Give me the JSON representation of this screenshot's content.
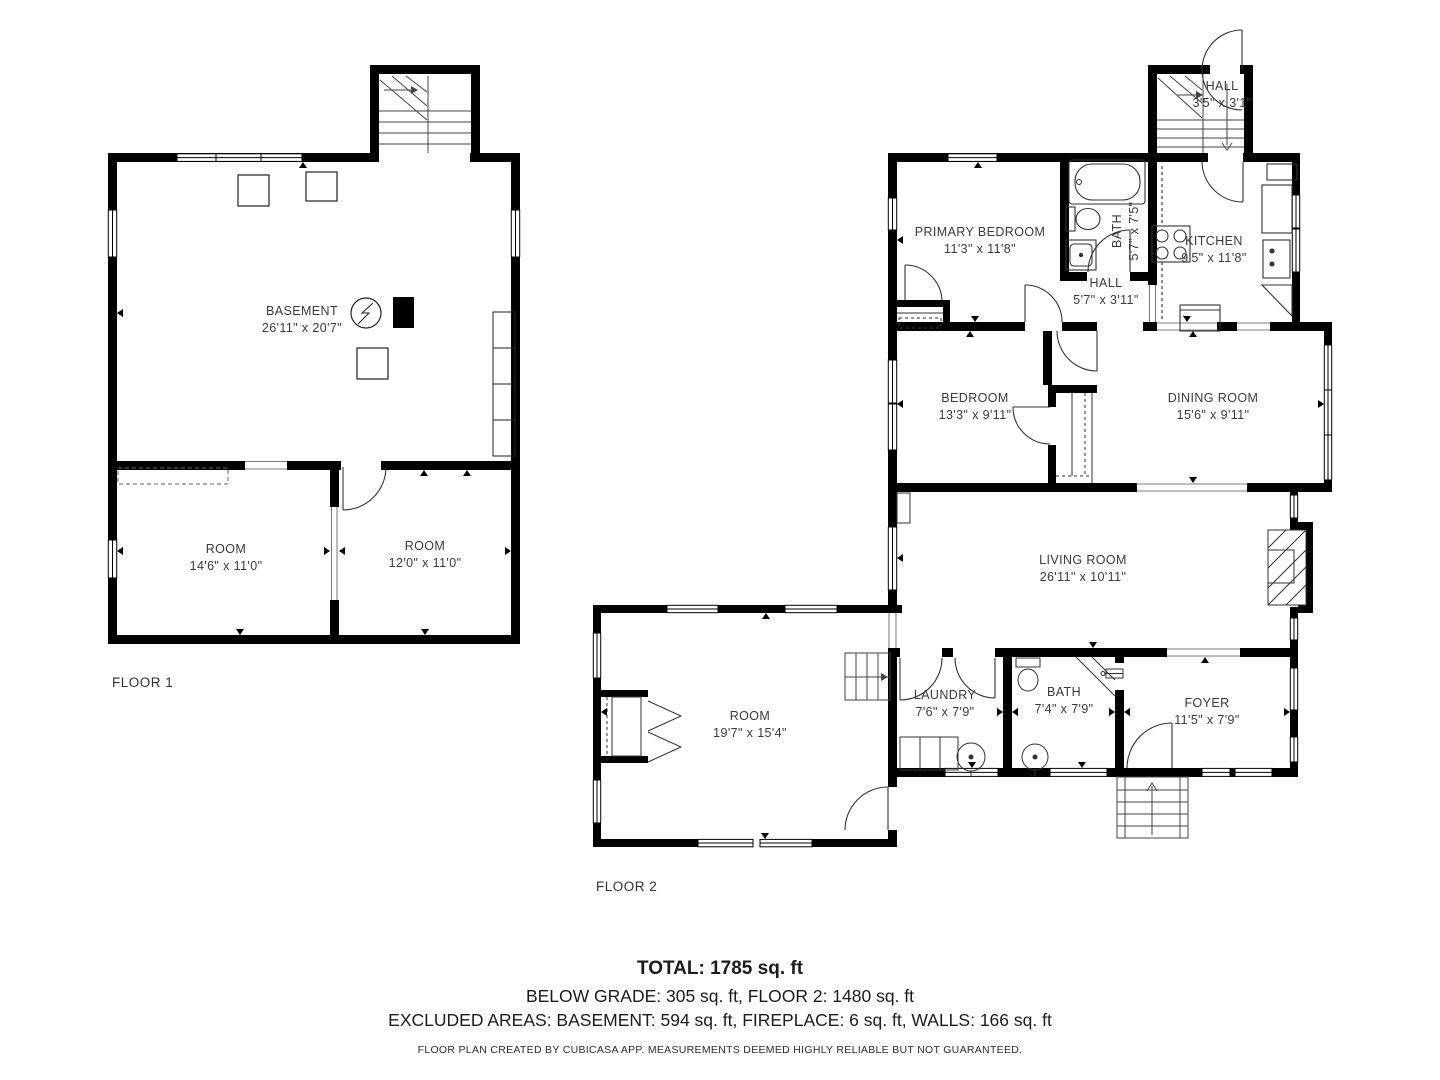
{
  "floors": [
    {
      "label": "FLOOR 1",
      "rooms": [
        {
          "name": "BASEMENT",
          "dims": "26'11\" x 20'7\""
        },
        {
          "name": "ROOM",
          "dims": "14'6\" x 11'0\""
        },
        {
          "name": "ROOM",
          "dims": "12'0\" x 11'0\""
        }
      ]
    },
    {
      "label": "FLOOR 2",
      "rooms": [
        {
          "name": "HALL",
          "dims": "3'5\" x 3'1\""
        },
        {
          "name": "PRIMARY BEDROOM",
          "dims": "11'3\" x 11'8\""
        },
        {
          "name": "BATH",
          "dims": "5'7\" x 7'5\""
        },
        {
          "name": "KITCHEN",
          "dims": "9'5\" x 11'8\""
        },
        {
          "name": "HALL",
          "dims": "5'7\" x 3'11\""
        },
        {
          "name": "BEDROOM",
          "dims": "13'3\" x 9'11\""
        },
        {
          "name": "DINING ROOM",
          "dims": "15'6\" x 9'11\""
        },
        {
          "name": "LIVING ROOM",
          "dims": "26'11\" x 10'11\""
        },
        {
          "name": "ROOM",
          "dims": "19'7\" x 15'4\""
        },
        {
          "name": "LAUNDRY",
          "dims": "7'6\" x 7'9\""
        },
        {
          "name": "BATH",
          "dims": "7'4\" x 7'9\""
        },
        {
          "name": "FOYER",
          "dims": "11'5\" x 7'9\""
        }
      ]
    }
  ],
  "summary": {
    "total": "TOTAL: 1785 sq. ft",
    "line2": "BELOW GRADE: 305 sq. ft, FLOOR 2: 1480 sq. ft",
    "line3": "EXCLUDED AREAS: BASEMENT: 594 sq. ft, FIREPLACE: 6 sq. ft, WALLS: 166 sq. ft",
    "disclaimer": "FLOOR PLAN CREATED BY CUBICASA APP. MEASUREMENTS DEEMED HIGHLY RELIABLE BUT NOT GUARANTEED."
  },
  "colors": {
    "wall": "#000000",
    "background": "#ffffff",
    "label": "#3b3b3b"
  }
}
